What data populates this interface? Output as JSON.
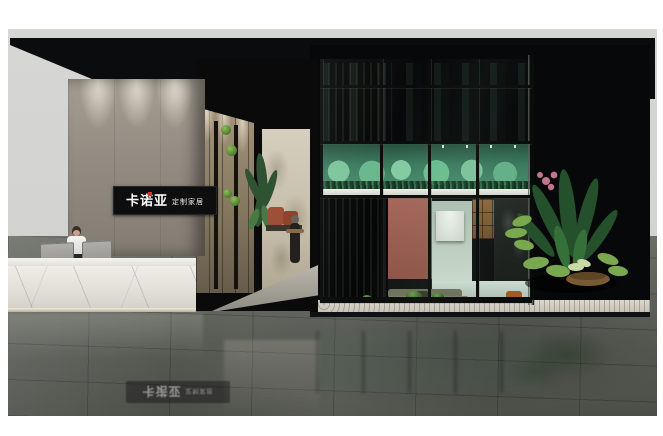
{
  "scene": {
    "kind": "3d-showroom-render",
    "description": "Exhibition booth rendering: reception desk with marble counter, branded concrete wall, corridor with moss decor, and a black-framed glass showroom with green mezzanine and living-room display",
    "brand": {
      "logo_text": "卡诺亚",
      "logo_subtext": "定制家居",
      "logo_bg_color": "#0e0e0e",
      "logo_text_color": "#ffffff",
      "logo_accent_color": "#d9342b"
    },
    "floor_reflection": {
      "logo_text": "卡诺亚",
      "logo_subtext": "定制家居"
    },
    "palette": {
      "backdrop_grey": "#d2d2d0",
      "canopy_black": "#0b0c0e",
      "concrete_wall": "#918a80",
      "wood_panel": "#85785f",
      "marble_desk": "#eceae4",
      "floor_dark_marble": "#5d5f59",
      "mezzanine_green": "#3c7a5e",
      "lotus_green": "#7cc49c",
      "salmon_wall": "#a5675a",
      "mint_cabinet": "#ccdcd1",
      "sofa_olive": "#6f715c",
      "gravel_white": "#dcd8cd",
      "plant_green": "#2c5a31",
      "flower_pink": "#c0758a",
      "bench_rust": "#9e4f38"
    }
  }
}
